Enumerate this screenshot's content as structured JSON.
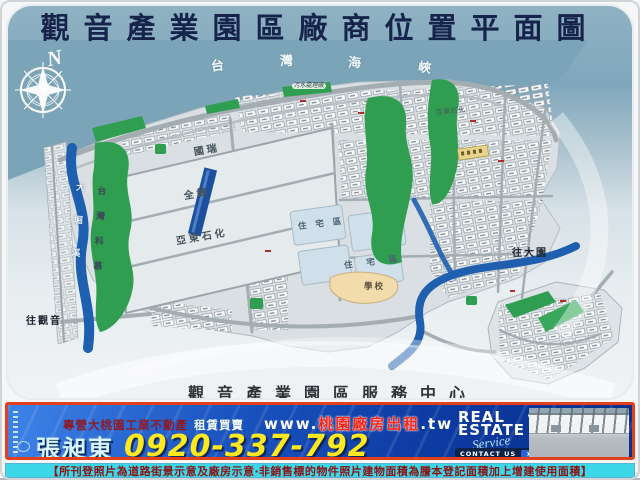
{
  "title": "觀音產業園區廠商位置平面圖",
  "map": {
    "compass": "N",
    "sea_chars": [
      "台",
      "灣",
      "海",
      "峽"
    ],
    "sewage_plant": "污水處理廠",
    "block_labels": {
      "guorui": "國瑞",
      "quanfeng": "全鋒",
      "yadong": "亞東石化",
      "yadong_small": "亞東石化"
    },
    "area_labels": {
      "chemours": "台灣科慕",
      "school": "學校",
      "residential_1": "住宅區",
      "residential_2": "住宅區"
    },
    "river_label": "大堀溪",
    "direction_labels": {
      "to_guanyin": "往觀音",
      "to_dayuan": "往大園"
    },
    "bottom_caption": "觀音產業園區服務中心"
  },
  "banner": {
    "tagline_prefix": "專營大桃園工業不動產",
    "tagline_suffix": "租賃買賣",
    "website_prefix": "www.",
    "website_domain": "桃園廠房出租",
    "website_tld": ".tw",
    "agent_name": "張昶東",
    "phone": "0920-337-792",
    "logo": {
      "line1": "REAL",
      "line2": "ESTATE",
      "script": "Service"
    },
    "contact_button": "CONTACT US",
    "contact_arrow": "➤",
    "colors": {
      "border": "#e2401c",
      "bg_dark": "#0a2f8c",
      "bg_light": "#3e83e8",
      "phone": "#ffe81c",
      "agent": "#d8f4ff",
      "tagline_dark": "#8e1a26",
      "website_domain": "#ff2416"
    }
  },
  "disclaimer": {
    "text": "【所刊登照片為道路街景示意及廠房示意‧非銷售標的物件照片建物面積為謄本登記面積加上增建使用面積】",
    "colors": {
      "bg": "#3cd8ea",
      "text": "#8e1212"
    }
  },
  "map_colors": {
    "sea": "#7fa7bc",
    "land": "#dde3e6",
    "green": "#2f9e50",
    "river": "#1e5fb0",
    "road": "#a3adb2",
    "school_area": "#f2dcab",
    "residential_area": "#cfe0ea",
    "pier": "#1c4f9e"
  }
}
